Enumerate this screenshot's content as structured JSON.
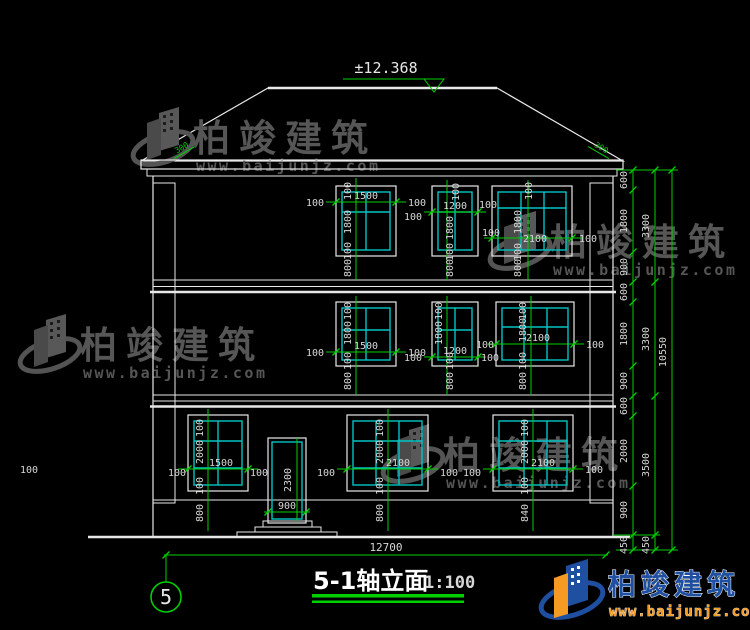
{
  "drawing": {
    "elevation_mark": "±12.368",
    "slope_mark": "300",
    "total_width": "12700",
    "axis_no": "5",
    "title": "5-1轴立面",
    "scale": "1:100"
  },
  "dims": {
    "d100": "100",
    "d800": "800",
    "d840": "840",
    "w1500": "1500",
    "w1200": "1200",
    "w2100": "2100",
    "h1800": "1800",
    "h2000": "2000",
    "door_w": "900",
    "door_h": "2300",
    "chain_inner": [
      "600",
      "1800",
      "900",
      "600",
      "1800",
      "900",
      "600",
      "2000",
      "900",
      "450"
    ],
    "chain_mid": [
      "3300",
      "3300",
      "3500",
      "450"
    ],
    "chain_outer": [
      "10550"
    ]
  },
  "watermark": {
    "brand": "柏竣建筑",
    "site": "www.baijunjz.com"
  },
  "logo": {
    "brand": "柏竣建筑",
    "site": "www.baijunjz.com"
  },
  "colors": {
    "dim_line": "#00cf00",
    "window_frame": "#00c4c4",
    "outline": "#e8e8e8",
    "brand_blue": "#1e4fa0",
    "brand_orange": "#f59a23"
  }
}
